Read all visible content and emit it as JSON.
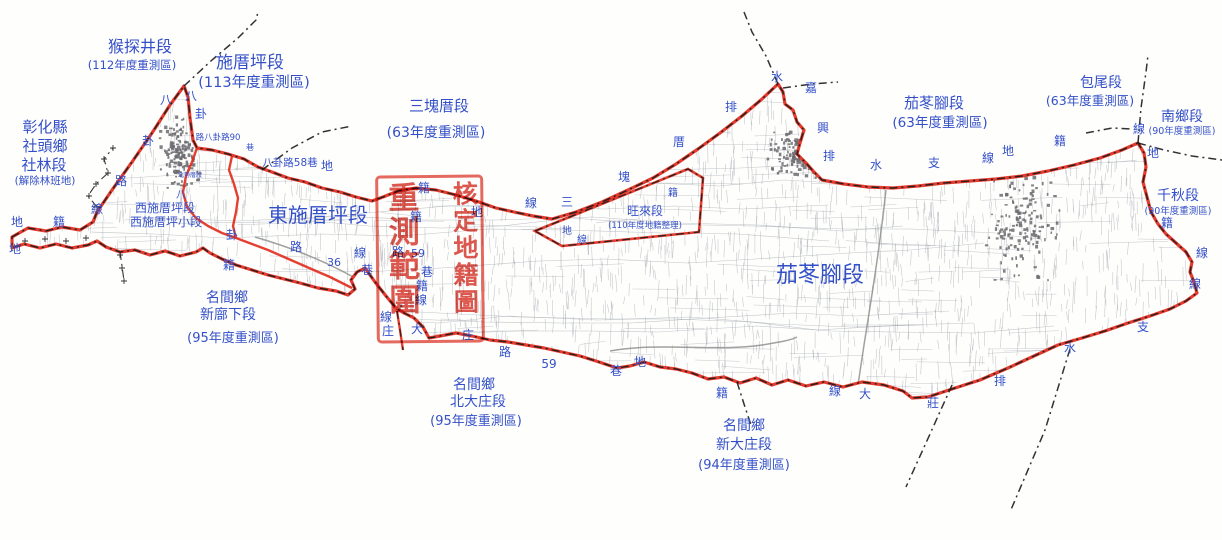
{
  "map": {
    "colors": {
      "label_blue": "#3450c8",
      "boundary_red": "#e22a1c",
      "admin_black": "#1c1c1c",
      "parcel_gray": "#9094a0",
      "town_gray": "#6b6b70",
      "stamp_red": "#d8352a"
    },
    "stamp": {
      "left_column": "重測範圍",
      "right_column": "核定地籍圖",
      "full_text": "重測範圍核定地籍圖"
    },
    "region_labels": [
      {
        "n": "label-houtanjing-section",
        "t": "猴探井段",
        "x": 140,
        "y": 52,
        "s": 16
      },
      {
        "n": "label-houtanjing-year",
        "t": "(112年度重測區)",
        "x": 132,
        "y": 69,
        "s": 11.5
      },
      {
        "n": "label-shicuoping-section",
        "t": "施厝坪段",
        "x": 250,
        "y": 68,
        "s": 17
      },
      {
        "n": "label-shicuoping-year",
        "t": "(113年度重測區)",
        "x": 254,
        "y": 87,
        "s": 14.5
      },
      {
        "n": "label-changhua-county",
        "t": "彰化縣",
        "x": 45,
        "y": 132,
        "s": 15
      },
      {
        "n": "label-shetou-township",
        "t": "社頭鄉",
        "x": 45,
        "y": 151,
        "s": 15
      },
      {
        "n": "label-shelin-section",
        "t": "社林段",
        "x": 44,
        "y": 170,
        "s": 15
      },
      {
        "n": "label-shelin-note",
        "t": "(解除林班地)",
        "x": 45,
        "y": 184,
        "s": 10.5
      },
      {
        "n": "label-sankuaicuo-section",
        "t": "三塊厝段",
        "x": 439,
        "y": 111,
        "s": 15
      },
      {
        "n": "label-sankuaicuo-year",
        "t": "(63年度重測區)",
        "x": 436,
        "y": 137,
        "s": 14
      },
      {
        "n": "label-dongshicuoping-section",
        "t": "東施厝坪段",
        "x": 318,
        "y": 222,
        "s": 20
      },
      {
        "n": "label-xishicuoping-section",
        "t": "西施厝坪段",
        "x": 165,
        "y": 212,
        "s": 12
      },
      {
        "n": "label-xishicuoping-subsection",
        "t": "西施厝坪小段",
        "x": 166,
        "y": 226,
        "s": 12
      },
      {
        "n": "label-wanglai-section",
        "t": "旺來段",
        "x": 645,
        "y": 215,
        "s": 12
      },
      {
        "n": "label-wanglai-year",
        "t": "(110年度地籍整理)",
        "x": 645,
        "y": 228,
        "s": 8.5
      },
      {
        "n": "label-qiedongjiao-section",
        "t": "茄苳腳段",
        "x": 934,
        "y": 108,
        "s": 15
      },
      {
        "n": "label-qiedongjiao-year",
        "t": "(63年度重測區)",
        "x": 940,
        "y": 127,
        "s": 13.5
      },
      {
        "n": "label-baowei-section",
        "t": "包尾段",
        "x": 1101,
        "y": 87,
        "s": 14
      },
      {
        "n": "label-baowei-year",
        "t": "(63年度重測區)",
        "x": 1090,
        "y": 105,
        "s": 12.5
      },
      {
        "n": "label-nanxiang-section",
        "t": "南鄉段",
        "x": 1182,
        "y": 121,
        "s": 14
      },
      {
        "n": "label-nanxiang-year",
        "t": "(90年度重測區)",
        "x": 1182,
        "y": 134,
        "s": 9.5
      },
      {
        "n": "label-qianqiu-section",
        "t": "千秋段",
        "x": 1178,
        "y": 200,
        "s": 14
      },
      {
        "n": "label-qianqiu-year",
        "t": "(90年度重測區)",
        "x": 1178,
        "y": 214,
        "s": 9.5
      },
      {
        "n": "label-qiedongjiao-big",
        "t": "茄苳腳段",
        "x": 820,
        "y": 282,
        "s": 22
      },
      {
        "n": "label-mingjian-1",
        "t": "名間鄉",
        "x": 227,
        "y": 302,
        "s": 14
      },
      {
        "n": "label-xinbuxia-section",
        "t": "新廍下段",
        "x": 228,
        "y": 319,
        "s": 14
      },
      {
        "n": "label-xinbuxia-year",
        "t": "(95年度重測區)",
        "x": 233,
        "y": 342,
        "s": 13
      },
      {
        "n": "label-mingjian-2",
        "t": "名間鄉",
        "x": 474,
        "y": 389,
        "s": 14
      },
      {
        "n": "label-beidazhuang-section",
        "t": "北大庄段",
        "x": 478,
        "y": 406,
        "s": 14
      },
      {
        "n": "label-beidazhuang-year",
        "t": "(95年度重測區)",
        "x": 476,
        "y": 425,
        "s": 13
      },
      {
        "n": "label-mingjian-3",
        "t": "名間鄉",
        "x": 744,
        "y": 430,
        "s": 14
      },
      {
        "n": "label-xindazhuang-section",
        "t": "新大庄段",
        "x": 744,
        "y": 449,
        "s": 14
      },
      {
        "n": "label-xindazhuang-year",
        "t": "(94年度重測區)",
        "x": 744,
        "y": 469,
        "s": 13
      },
      {
        "n": "label-beishicuo",
        "t": "北勢厝段",
        "x": 190,
        "y": 177,
        "s": 6
      },
      {
        "n": "label-road-bagua90",
        "t": "路八卦路90",
        "x": 218,
        "y": 140,
        "s": 8.5
      },
      {
        "n": "label-road-bagua90-lane",
        "t": "巷",
        "x": 250,
        "y": 150,
        "s": 8
      },
      {
        "n": "label-road-bagua58",
        "t": "八卦路58巷",
        "x": 290,
        "y": 166,
        "s": 10.5
      },
      {
        "n": "label-road-36",
        "t": "36",
        "x": 334,
        "y": 266,
        "s": 11
      },
      {
        "n": "label-road-59a",
        "t": "59",
        "x": 418,
        "y": 257,
        "s": 11
      },
      {
        "n": "label-road-59b",
        "t": "59",
        "x": 549,
        "y": 368,
        "s": 12
      }
    ],
    "boundary_chars": [
      {
        "t": "地",
        "x": 17,
        "y": 226
      },
      {
        "t": "籍",
        "x": 59,
        "y": 226
      },
      {
        "t": "地",
        "x": 15,
        "y": 253
      },
      {
        "t": "線",
        "x": 97,
        "y": 213
      },
      {
        "t": "路",
        "x": 121,
        "y": 185
      },
      {
        "t": "卦",
        "x": 148,
        "y": 145
      },
      {
        "t": "八",
        "x": 166,
        "y": 104
      },
      {
        "t": "八",
        "x": 191,
        "y": 100
      },
      {
        "t": "卦",
        "x": 201,
        "y": 118
      },
      {
        "t": "八",
        "x": 181,
        "y": 198,
        "s": 10
      },
      {
        "t": "卦",
        "x": 232,
        "y": 239
      },
      {
        "t": "籍",
        "x": 229,
        "y": 269
      },
      {
        "t": "路",
        "x": 296,
        "y": 251
      },
      {
        "t": "線",
        "x": 360,
        "y": 257
      },
      {
        "t": "巷",
        "x": 367,
        "y": 274
      },
      {
        "t": "地",
        "x": 327,
        "y": 170
      },
      {
        "t": "籍",
        "x": 424,
        "y": 192
      },
      {
        "t": "籍",
        "x": 416,
        "y": 221
      },
      {
        "t": "路",
        "x": 398,
        "y": 256
      },
      {
        "t": "巷",
        "x": 427,
        "y": 276
      },
      {
        "t": "籍",
        "x": 422,
        "y": 290
      },
      {
        "t": "線",
        "x": 421,
        "y": 304
      },
      {
        "t": "線",
        "x": 386,
        "y": 321
      },
      {
        "t": "庄",
        "x": 388,
        "y": 335
      },
      {
        "t": "大",
        "x": 417,
        "y": 333
      },
      {
        "t": "庄",
        "x": 468,
        "y": 339
      },
      {
        "t": "線",
        "x": 531,
        "y": 207
      },
      {
        "t": "三",
        "x": 567,
        "y": 206
      },
      {
        "t": "地",
        "x": 477,
        "y": 216
      },
      {
        "t": "塊",
        "x": 624,
        "y": 181
      },
      {
        "t": "厝",
        "x": 679,
        "y": 146
      },
      {
        "t": "籍",
        "x": 673,
        "y": 196,
        "s": 10
      },
      {
        "t": "地",
        "x": 567,
        "y": 234,
        "s": 10
      },
      {
        "t": "線",
        "x": 582,
        "y": 243,
        "s": 10
      },
      {
        "t": "排",
        "x": 731,
        "y": 111
      },
      {
        "t": "水",
        "x": 777,
        "y": 81
      },
      {
        "t": "嘉",
        "x": 811,
        "y": 92
      },
      {
        "t": "興",
        "x": 823,
        "y": 132
      },
      {
        "t": "排",
        "x": 829,
        "y": 160
      },
      {
        "t": "水",
        "x": 876,
        "y": 169
      },
      {
        "t": "支",
        "x": 934,
        "y": 167
      },
      {
        "t": "線",
        "x": 988,
        "y": 162
      },
      {
        "t": "地",
        "x": 1008,
        "y": 155
      },
      {
        "t": "籍",
        "x": 1060,
        "y": 145
      },
      {
        "t": "線",
        "x": 1139,
        "y": 133
      },
      {
        "t": "地",
        "x": 1153,
        "y": 157
      },
      {
        "t": "籍",
        "x": 1167,
        "y": 227
      },
      {
        "t": "線",
        "x": 1202,
        "y": 257
      },
      {
        "t": "線",
        "x": 1195,
        "y": 288
      },
      {
        "t": "路",
        "x": 505,
        "y": 356
      },
      {
        "t": "巷",
        "x": 616,
        "y": 375
      },
      {
        "t": "地",
        "x": 640,
        "y": 366
      },
      {
        "t": "籍",
        "x": 722,
        "y": 397
      },
      {
        "t": "線",
        "x": 835,
        "y": 395
      },
      {
        "t": "大",
        "x": 865,
        "y": 398
      },
      {
        "t": "莊",
        "x": 933,
        "y": 407
      },
      {
        "t": "排",
        "x": 1000,
        "y": 385
      },
      {
        "t": "水",
        "x": 1070,
        "y": 352
      },
      {
        "t": "支",
        "x": 1143,
        "y": 331
      }
    ]
  }
}
